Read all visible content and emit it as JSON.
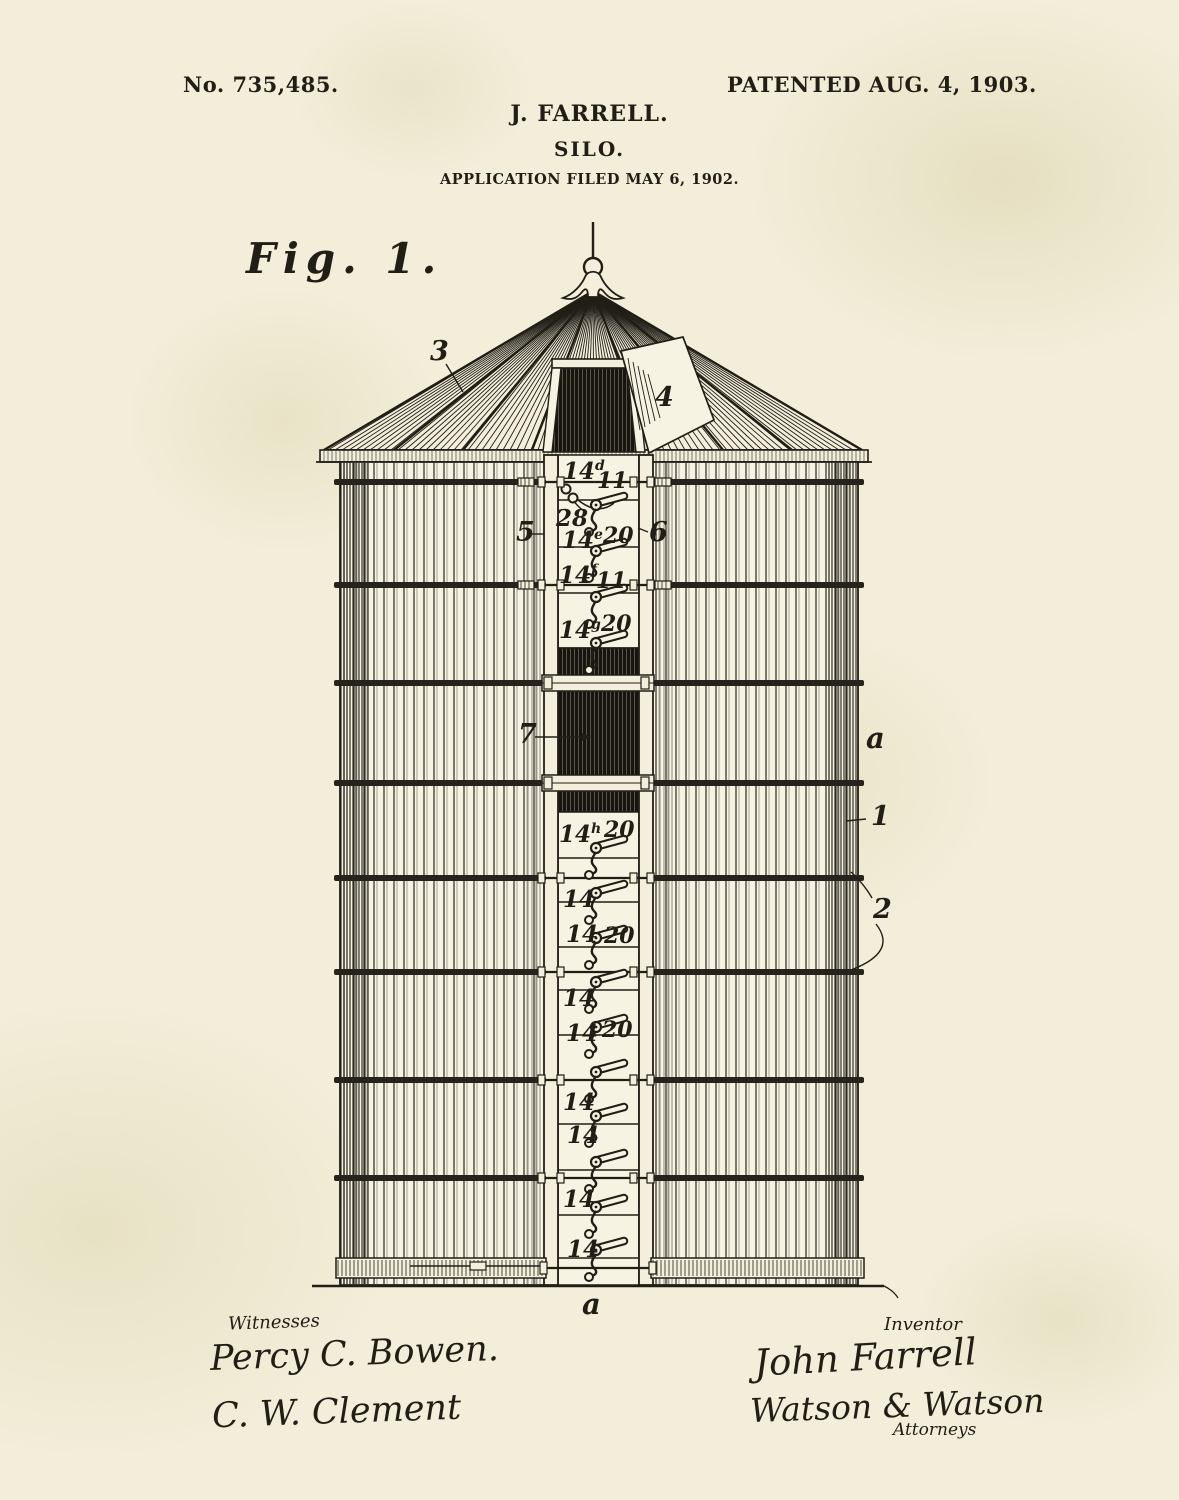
{
  "page": {
    "background_color": "#f2eeda",
    "ink_color": "#211e16",
    "patent_number": "No. 735,485.",
    "patent_date": "PATENTED AUG. 4, 1903.",
    "inventor_name": "J. FARRELL.",
    "invention_title": "SILO.",
    "application_line": "APPLICATION FILED MAY 6, 1902.",
    "figure_label": "Fig. 1."
  },
  "signatures": {
    "witnesses_heading": "Witnesses",
    "witness_1": "Percy C. Bowen.",
    "witness_2": "C. W. Clement",
    "inventor_heading": "Inventor",
    "inventor_signature": "John Farrell",
    "attorneys_signature": "Watson & Watson",
    "attorneys_heading": "Attorneys"
  },
  "drawing": {
    "hoops_y": [
      482,
      585,
      683,
      783,
      878,
      972,
      1080,
      1178
    ],
    "threaded_rod_hoops_y": [
      482,
      585
    ],
    "door_band_ys": [
      683,
      783
    ],
    "panel_divider_ys": [
      500,
      547,
      593,
      648,
      858,
      902,
      947,
      990,
      1035,
      1080,
      1124,
      1170,
      1215,
      1258
    ],
    "latch_pivot_ys": [
      505,
      551,
      597,
      643,
      848,
      893,
      938,
      982,
      1027,
      1072,
      1116,
      1162,
      1207,
      1250
    ],
    "part_labels": [
      {
        "id": "roof",
        "text": "3",
        "x": 430,
        "y": 360
      },
      {
        "id": "roof-hatch",
        "text": "4",
        "x": 655,
        "y": 406
      },
      {
        "id": "left-door-rail",
        "text": "5",
        "x": 516,
        "y": 541
      },
      {
        "id": "right-door-rail",
        "text": "6",
        "x": 649,
        "y": 541
      },
      {
        "id": "chute-door",
        "text": "7",
        "x": 518,
        "y": 743
      },
      {
        "id": "wall",
        "text": "a",
        "x": 866,
        "y": 748
      },
      {
        "id": "stave",
        "text": "1",
        "x": 871,
        "y": 825
      },
      {
        "id": "hoop-pair",
        "text": "2",
        "x": 873,
        "y": 918
      },
      {
        "id": "base",
        "text": "a",
        "x": 582,
        "y": 1314
      }
    ],
    "column_labels": [
      {
        "base": "14",
        "sup": "d",
        "x": 563,
        "y": 479,
        "sec": "11",
        "sx": 597,
        "sy": 488
      },
      {
        "base": "28",
        "x": 556,
        "y": 526
      },
      {
        "base": "14",
        "sup": "e",
        "x": 562,
        "y": 548,
        "sec": "20",
        "sx": 603,
        "sy": 543
      },
      {
        "base": "14",
        "sup": "f",
        "x": 559,
        "y": 583,
        "sec": "11",
        "sx": 596,
        "sy": 588
      },
      {
        "base": "14",
        "sup": "g",
        "x": 559,
        "y": 638,
        "sec": "20",
        "sx": 601,
        "sy": 631
      },
      {
        "base": "14",
        "sup": "h",
        "x": 559,
        "y": 842,
        "sec": "20",
        "sx": 604,
        "sy": 837
      },
      {
        "base": "14",
        "x": 563,
        "y": 907
      },
      {
        "base": "14",
        "x": 566,
        "y": 942,
        "sec": "20",
        "sx": 604,
        "sy": 943
      },
      {
        "base": "14",
        "x": 563,
        "y": 1006
      },
      {
        "base": "14",
        "x": 566,
        "y": 1041,
        "sec": "20",
        "sx": 602,
        "sy": 1037
      },
      {
        "base": "14",
        "x": 563,
        "y": 1110
      },
      {
        "base": "14",
        "x": 567,
        "y": 1143
      },
      {
        "base": "14",
        "x": 563,
        "y": 1207
      },
      {
        "base": "14",
        "x": 567,
        "y": 1257
      }
    ]
  }
}
